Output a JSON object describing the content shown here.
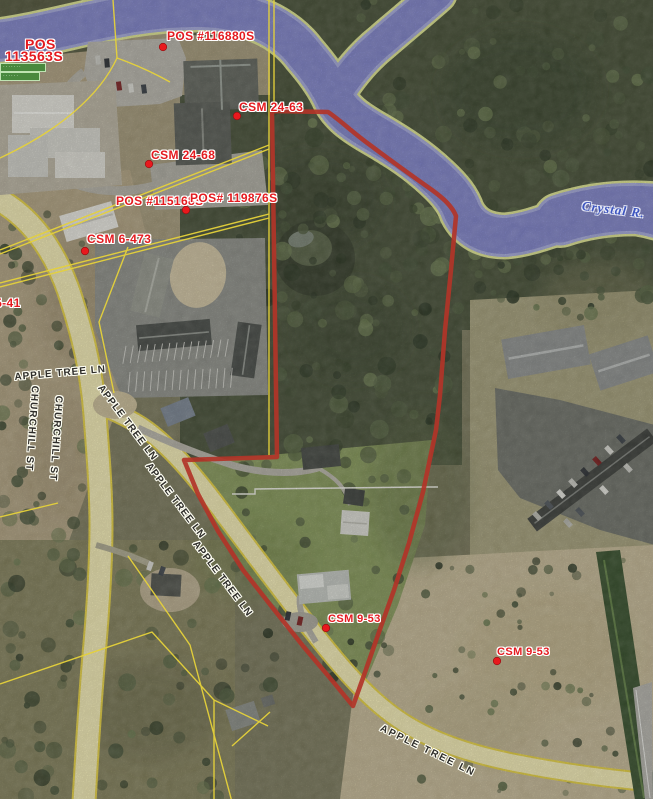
{
  "document_labels": [
    {
      "text": "POS"
    },
    {
      "text": "113563S"
    },
    {
      "text": "POS #116880S"
    },
    {
      "text": "CSM 24-63"
    },
    {
      "text": "CSM 24-68"
    },
    {
      "text": "POS #115168S"
    },
    {
      "text": "POS# 119876S"
    },
    {
      "text": "CSM 6-473"
    },
    {
      "text": "35-41"
    },
    {
      "text": "CSM 9-53"
    },
    {
      "text": "CSM 9-53"
    }
  ],
  "street_labels": [
    {
      "text": "CHURCHILL ST"
    },
    {
      "text": "CHURCHILL ST"
    },
    {
      "text": "APPLE TREE LN"
    },
    {
      "text": "APPLE TREE LN"
    },
    {
      "text": "APPLE TREE LN"
    },
    {
      "text": "APPLE TREE LN"
    },
    {
      "text": "APPLE TREE LN"
    }
  ],
  "water_label": {
    "text": "Crystal R."
  },
  "small_label": {
    "line1": "·······",
    "line2": "······"
  },
  "colors": {
    "boundary_red": "#b23428",
    "marker_red": "#e8191d",
    "parcel_line_yellow": "#e6d23a",
    "water_blue": "#8084c8",
    "water_bank": "#dce291",
    "road_cream": "#f0e9b4",
    "road_edge_yellow": "#e3cf44"
  }
}
